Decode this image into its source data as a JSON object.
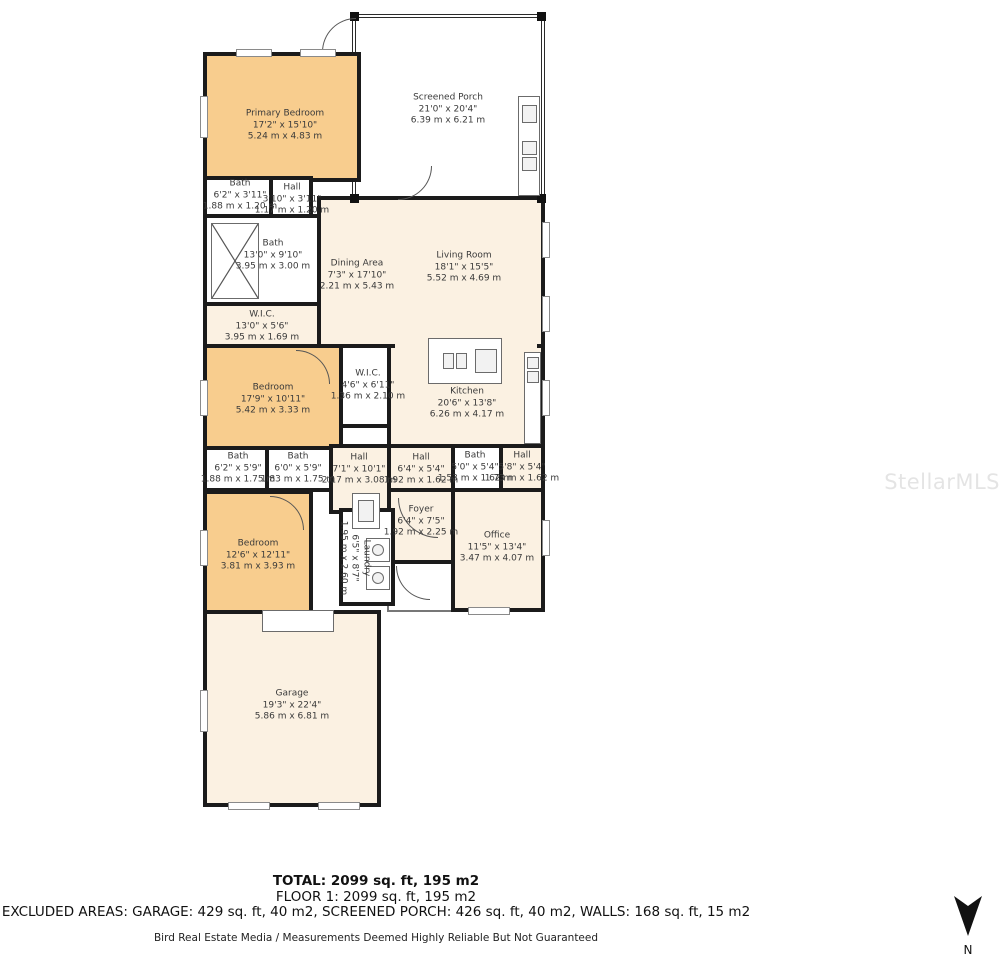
{
  "watermark": "StellarMLS",
  "summary": {
    "total": "TOTAL: 2099 sq. ft, 195 m2",
    "floor": "FLOOR 1: 2099 sq. ft, 195 m2",
    "excluded": "EXCLUDED AREAS: GARAGE: 429 sq. ft, 40 m2, SCREENED PORCH: 426 sq. ft, 40 m2, WALLS: 168 sq. ft, 15 m2",
    "disclaimer": "Bird Real Estate Media / Measurements Deemed Highly Reliable But Not Guaranteed"
  },
  "compass": {
    "label": "N"
  },
  "colors": {
    "bedroom_fill": "#f8cd8e",
    "living_fill": "#fbf1e2",
    "wet_room_fill": "#ffffff",
    "wall": "#1b1b1b",
    "label_text": "#3a3a3a"
  },
  "rooms": [
    {
      "name": "Primary Bedroom",
      "imperial": "17'2\" x 15'10\"",
      "metric": "5.24 m x 4.83 m"
    },
    {
      "name": "Screened Porch",
      "imperial": "21'0\" x 20'4\"",
      "metric": "6.39 m x 6.21 m"
    },
    {
      "name": "Bath",
      "imperial": "6'2\" x 3'11\"",
      "metric": "1.88 m x 1.20 m"
    },
    {
      "name": "Hall",
      "imperial": "3'10\" x 3'11\"",
      "metric": "1.17 m x 1.20 m"
    },
    {
      "name": "Bath",
      "imperial": "13'0\" x 9'10\"",
      "metric": "3.95 m x 3.00 m"
    },
    {
      "name": "W.I.C.",
      "imperial": "13'0\" x 5'6\"",
      "metric": "3.95 m x 1.69 m"
    },
    {
      "name": "Dining Area",
      "imperial": "7'3\" x 17'10\"",
      "metric": "2.21 m x 5.43 m"
    },
    {
      "name": "Living Room",
      "imperial": "18'1\" x 15'5\"",
      "metric": "5.52 m x 4.69 m"
    },
    {
      "name": "Bedroom",
      "imperial": "17'9\" x 10'11\"",
      "metric": "5.42 m x 3.33 m"
    },
    {
      "name": "W.I.C.",
      "imperial": "4'6\" x 6'11\"",
      "metric": "1.36 m x 2.10 m"
    },
    {
      "name": "Kitchen",
      "imperial": "20'6\" x 13'8\"",
      "metric": "6.26 m x 4.17 m"
    },
    {
      "name": "Bath",
      "imperial": "6'2\" x 5'9\"",
      "metric": "1.88 m x 1.75 m"
    },
    {
      "name": "Bath",
      "imperial": "6'0\" x 5'9\"",
      "metric": "1.83 m x 1.75 m"
    },
    {
      "name": "Hall",
      "imperial": "7'1\" x 10'1\"",
      "metric": "2.17 m x 3.08 m"
    },
    {
      "name": "Hall",
      "imperial": "6'4\" x 5'4\"",
      "metric": "1.92 m x 1.62 m"
    },
    {
      "name": "Bath",
      "imperial": "5'0\" x 5'4\"",
      "metric": "1.53 m x 1.62 m"
    },
    {
      "name": "Hall",
      "imperial": "5'8\" x 5'4\"",
      "metric": "1.73 m x 1.62 m"
    },
    {
      "name": "Foyer",
      "imperial": "6'4\" x 7'5\"",
      "metric": "1.92 m x 2.25 m"
    },
    {
      "name": "Office",
      "imperial": "11'5\" x 13'4\"",
      "metric": "3.47 m x 4.07 m"
    },
    {
      "name": "Bedroom",
      "imperial": "12'6\" x 12'11\"",
      "metric": "3.81 m x 3.93 m"
    },
    {
      "name": "Laundry",
      "imperial": "6'5\" x 8'7\"",
      "metric": "1.95 m x 2.60 m"
    },
    {
      "name": "Garage",
      "imperial": "19'3\" x 22'4\"",
      "metric": "5.86 m x 6.81 m"
    }
  ]
}
